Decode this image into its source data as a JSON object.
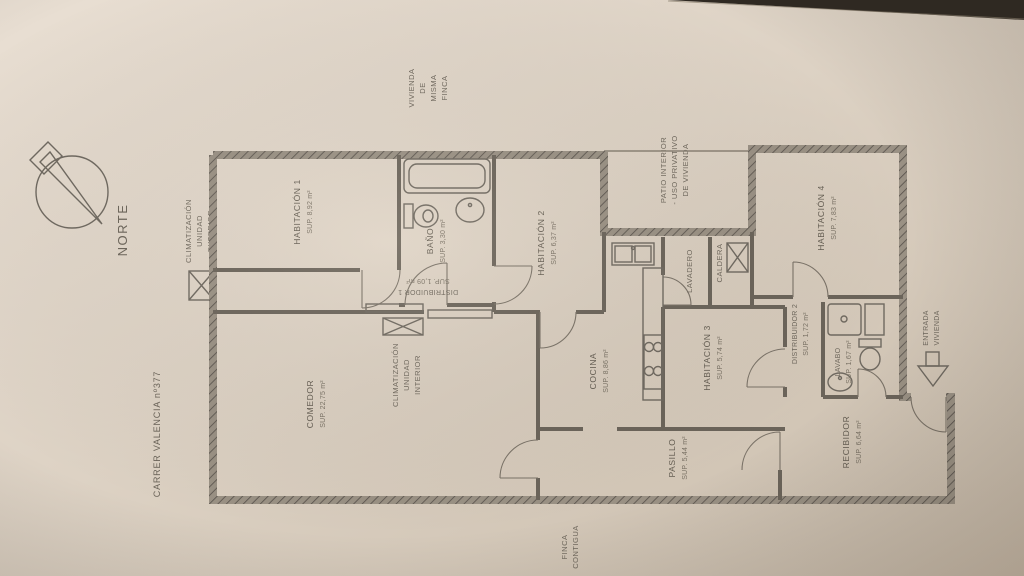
{
  "colors": {
    "paper": "#ded3c5",
    "ink": "#6a6358",
    "wall": "#9a9184",
    "dark_edge": "#2f2922"
  },
  "compass": {
    "label": "NORTE"
  },
  "street_label": "CARRER VALENCIA nº377",
  "hvac_exterior": {
    "lines": [
      "CLIMATIZACIÓN",
      "UNIDAD",
      "EXTERIOR"
    ]
  },
  "hvac_interior": {
    "lines": [
      "CLIMATIZACIÓN",
      "UNIDAD",
      "INTERIOR"
    ]
  },
  "rooms": {
    "habitacion1": {
      "name": "HABITACIÓN 1",
      "area": "SUP. 8,92 m²"
    },
    "bano": {
      "name": "BAÑO",
      "area": "SUP. 3,30 m²"
    },
    "habitacion2": {
      "name": "HABITACIÓN 2",
      "area": "SUP. 6,37 m²"
    },
    "distribuidor1": {
      "name": "DISTRIBUIDOR 1",
      "area": "SUP. 1,09 m²"
    },
    "comedor": {
      "name": "COMEDOR",
      "area": "SUP. 22,75 m²"
    },
    "cocina": {
      "name": "COCINA",
      "area": "SUP. 8,86 m²"
    },
    "lavadero": {
      "name": "LAVADERO"
    },
    "caldera": {
      "name": "CALDERA"
    },
    "habitacion3": {
      "name": "HABITACIÓN 3",
      "area": "SUP. 5,74 m²"
    },
    "habitacion4": {
      "name": "HABITACIÓN 4",
      "area": "SUP. 7,83 m²"
    },
    "distribuidor2": {
      "name": "DISTRIBUIDOR 2",
      "area": "SUP. 1,72 m²"
    },
    "lavabo": {
      "name": "LAVABO",
      "area": "SUP. 1,67 m²"
    },
    "recibidor": {
      "name": "RECIBIDOR",
      "area": "SUP. 6,64 m²"
    },
    "pasillo": {
      "name": "PASILLO",
      "area": "SUP. 5,44 m²"
    }
  },
  "surroundings": {
    "patio": {
      "lines": [
        "PATIO INTERIOR",
        "- USO PRIVATIVO",
        "DE VIVIENDA"
      ]
    },
    "vivienda_misma_finca": {
      "lines": [
        "VIVIENDA",
        "DE",
        "MISMA",
        "FINCA"
      ]
    },
    "finca_contigua": {
      "lines": [
        "FINCA",
        "CONTIGUA"
      ]
    },
    "entrada_vivienda": {
      "lines": [
        "ENTRADA",
        "VIVIENDA"
      ]
    }
  }
}
